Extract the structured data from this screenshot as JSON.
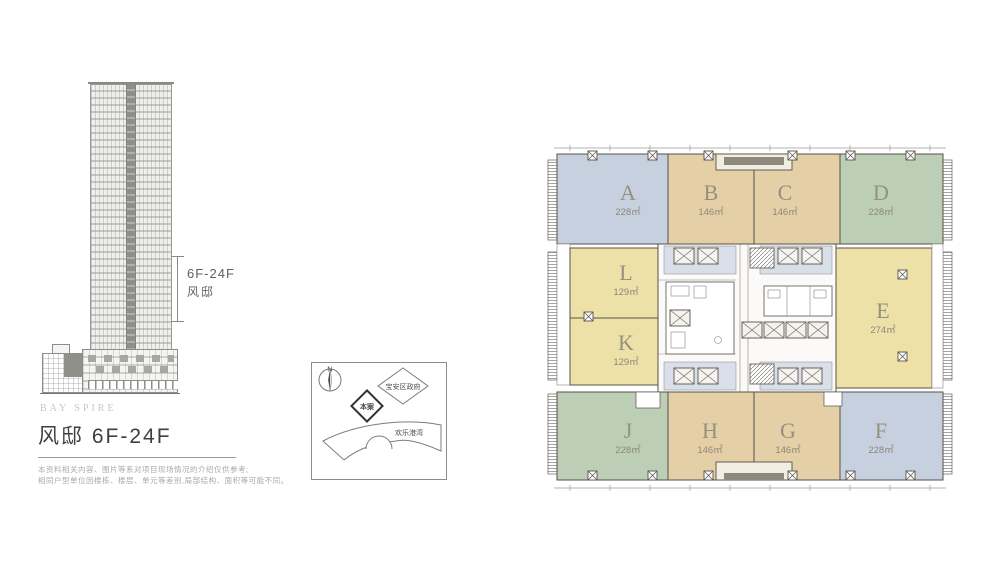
{
  "left_panel": {
    "range_label": "6F-24F",
    "range_sublabel": "风邸",
    "brand": "BAY SPIRE",
    "title": "风邸 6F-24F",
    "disclaimer_line1": "本资料相关内容、图片等系对项目现场情况的介绍仅供参考;",
    "disclaimer_line2": "相同户型单位因楼栋、楼层、单元等差别,局部结构、面积等可能不同。"
  },
  "site_map": {
    "north_label": "N",
    "site_label": "本案",
    "government_label": "宝安区政府",
    "bay_label": "欢乐港湾"
  },
  "floor_plan": {
    "units": [
      {
        "id": "A",
        "area": "228㎡",
        "color": "#c7d0df"
      },
      {
        "id": "B",
        "area": "146㎡",
        "color": "#e4cfa7"
      },
      {
        "id": "C",
        "area": "146㎡",
        "color": "#e4cfa7"
      },
      {
        "id": "D",
        "area": "228㎡",
        "color": "#bccfb6"
      },
      {
        "id": "L",
        "area": "129㎡",
        "color": "#eee1a8"
      },
      {
        "id": "K",
        "area": "129㎡",
        "color": "#eee1a8"
      },
      {
        "id": "E",
        "area": "274㎡",
        "color": "#eee1a8"
      },
      {
        "id": "J",
        "area": "228㎡",
        "color": "#bccfb6"
      },
      {
        "id": "H",
        "area": "146㎡",
        "color": "#e4cfa7"
      },
      {
        "id": "G",
        "area": "146㎡",
        "color": "#e4cfa7"
      },
      {
        "id": "F",
        "area": "228㎡",
        "color": "#c7d0df"
      }
    ]
  }
}
